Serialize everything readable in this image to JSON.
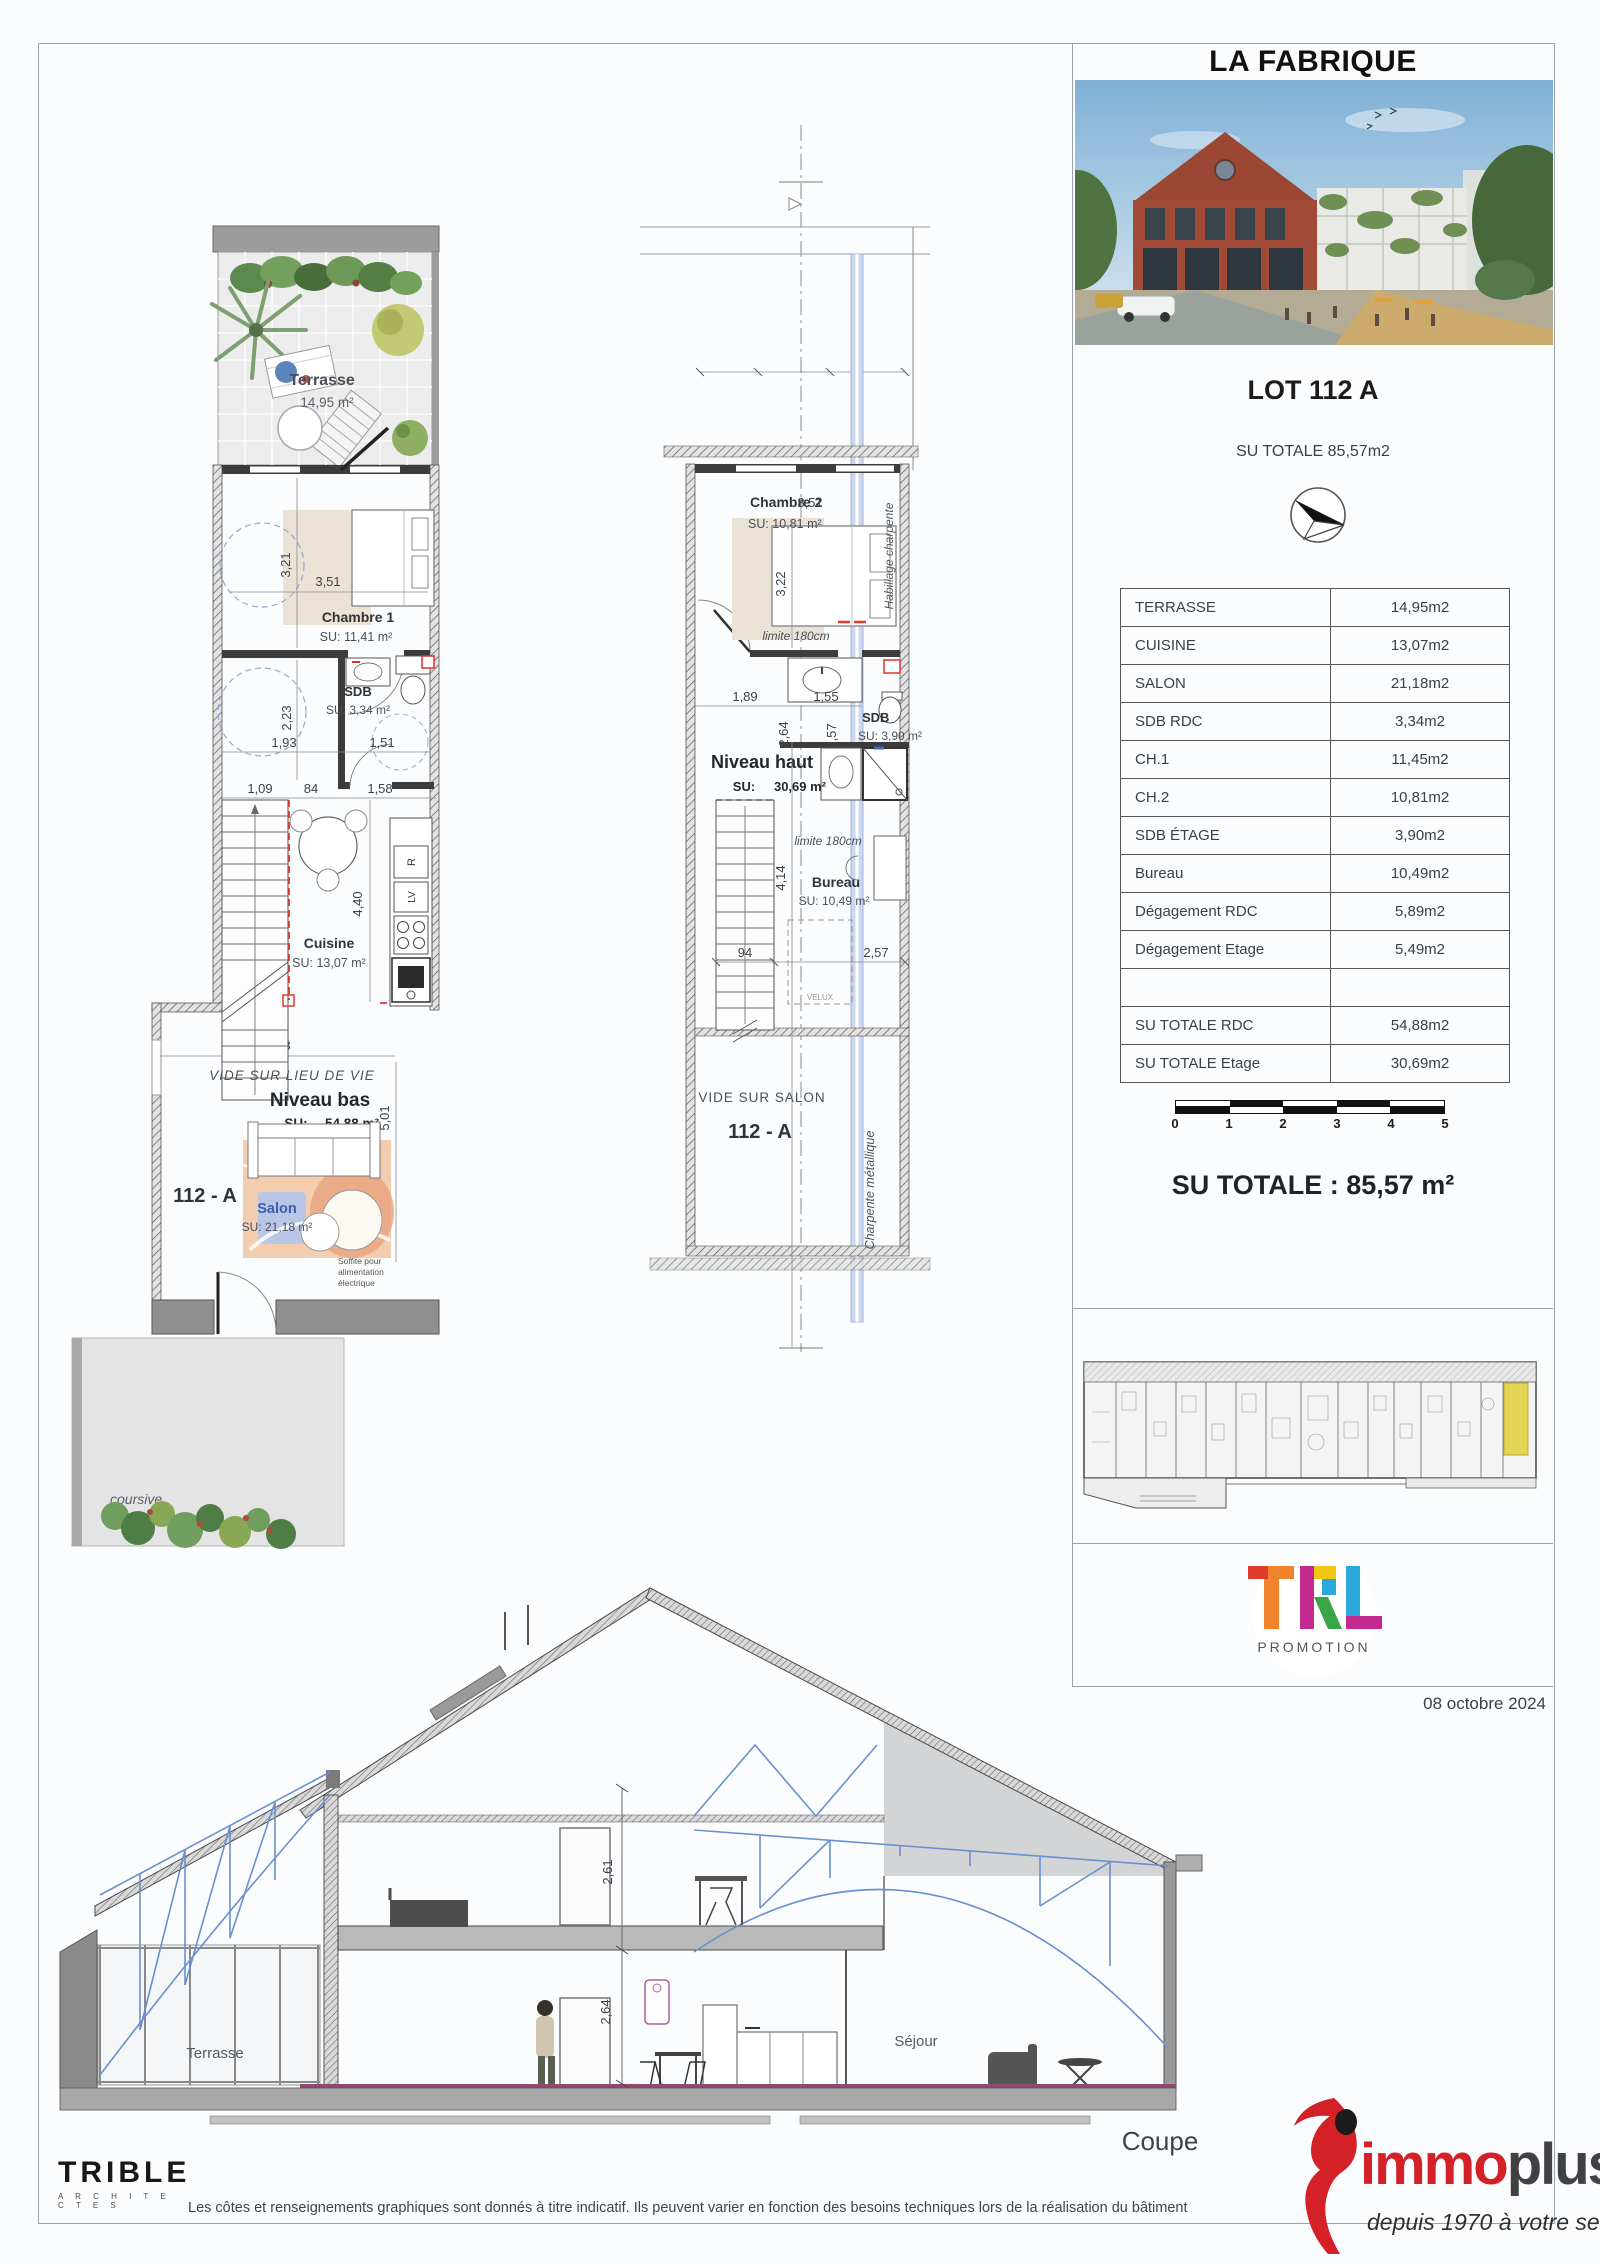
{
  "panel": {
    "title": "LA FABRIQUE",
    "lot": "LOT 112 A",
    "subtitle": "SU TOTALE 85,57m2",
    "table": [
      {
        "label": "TERRASSE",
        "value": "14,95m2"
      },
      {
        "label": "CUISINE",
        "value": "13,07m2"
      },
      {
        "label": "SALON",
        "value": "21,18m2"
      },
      {
        "label": "SDB RDC",
        "value": "3,34m2"
      },
      {
        "label": "CH.1",
        "value": "11,45m2"
      },
      {
        "label": "CH.2",
        "value": "10,81m2"
      },
      {
        "label": "SDB ÉTAGE",
        "value": "3,90m2"
      },
      {
        "label": "Bureau",
        "value": "10,49m2"
      },
      {
        "label": "Dégagement RDC",
        "value": "5,89m2"
      },
      {
        "label": "Dégagement Etage",
        "value": "5,49m2"
      },
      {
        "label": "",
        "value": ""
      },
      {
        "label": "SU TOTALE RDC",
        "value": "54,88m2"
      },
      {
        "label": "SU TOTALE Etage",
        "value": "30,69m2"
      }
    ],
    "scale_ticks": [
      "0",
      "1",
      "2",
      "3",
      "4",
      "5"
    ],
    "total": "SU TOTALE : 85,57 m²",
    "promoter": {
      "name_t": "T",
      "name_r": "R",
      "name_l": "L",
      "sub": "PROMOTION"
    },
    "date": "08 octobre 2024"
  },
  "plan_rdc": {
    "terrasse": {
      "name": "Terrasse",
      "su": "14,95 m²"
    },
    "chambre1": {
      "name": "Chambre 1",
      "su": "SU: 11,41 m²"
    },
    "sdb": {
      "name": "SDB",
      "su": "SU: 3,34 m²"
    },
    "cuisine": {
      "name": "Cuisine",
      "su": "SU: 13,07 m²"
    },
    "niveau": {
      "name": "Niveau bas",
      "su_label": "SU:",
      "su": "54,88 m²"
    },
    "salon": {
      "name": "Salon",
      "su": "SU: 21,18 m²"
    },
    "lot": "112 - A",
    "vide": "VIDE SUR LIEU DE VIE",
    "soffite1": "Soffite pour",
    "soffite2": "alimentation",
    "soffite3": "électrique",
    "coursive": "coursive",
    "appliances": {
      "fridge": "R",
      "dishwasher": "LV"
    },
    "dims": {
      "d1": "3,21",
      "d2": "3,51",
      "d3": "2,23",
      "d4": "1,93",
      "d5": "1,51",
      "d6": "1,09",
      "d7": "84",
      "d8": "1,58",
      "d9": "4,40",
      "d10": "4,28",
      "d11": "5,01"
    }
  },
  "plan_etage": {
    "chambre2": {
      "name": "Chambre 2",
      "su": "SU: 10,81 m²"
    },
    "habillage": "Habillage charpente",
    "limite_a": "limite 180cm",
    "limite_b": "limite 180cm",
    "sdb": {
      "name": "SDB",
      "su": "SU: 3,90 m²"
    },
    "niveau": {
      "name": "Niveau haut",
      "su_label": "SU:",
      "su": "30,69 m²"
    },
    "bureau": {
      "name": "Bureau",
      "su": "SU: 10,49 m²"
    },
    "velux": "VELUX",
    "vide": "VIDE SUR SALON",
    "lot": "112 - A",
    "charpente": "Charpente métallique",
    "dims": {
      "d1": "3,51",
      "d2": "3,22",
      "d3": "1,89",
      "d4": "1,55",
      "d5": "2,64",
      "d6": "2,57",
      "d7": "4,14",
      "d8": "94",
      "d9": "2,57"
    }
  },
  "coupe": {
    "terrasse": "Terrasse",
    "sejour": "Séjour",
    "title": "Coupe",
    "dims": {
      "upper": "2,61",
      "lower": "2,64"
    }
  },
  "footer": {
    "architect": "TRIBLE",
    "architect_sub": "A R C H I T E C T E S",
    "disclaimer": "Les côtes et renseignements graphiques sont donnés à titre indicatif. Ils peuvent varier en fonction des besoins techniques lors de la réalisation du bâtiment",
    "immoplus": {
      "part1": "immo",
      "part2": "plus",
      "tagline": "depuis 1970 à votre service"
    }
  },
  "colors": {
    "accent_red": "#d42027",
    "highlight_yellow": "#e3d553",
    "truss_blue": "#6b8fd0",
    "floor_purple": "#8e4a6e"
  }
}
